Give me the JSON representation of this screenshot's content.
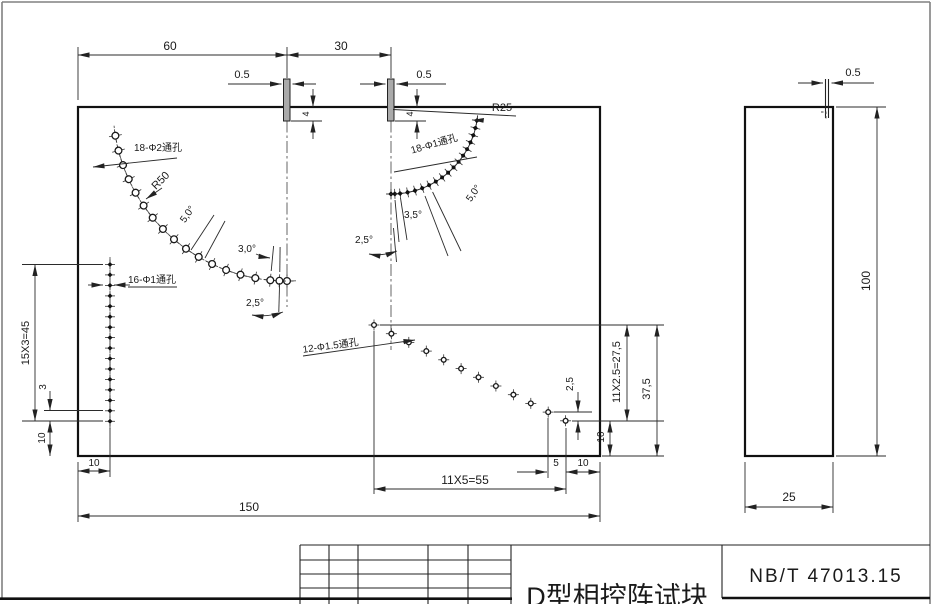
{
  "labels": {
    "dim_width_60": "60",
    "dim_width_30": "30",
    "notch1_width": "0.5",
    "notch2_width": "0.5",
    "side_notch_width": "0.5",
    "notch1_depth": "4",
    "notch2_depth": "4",
    "radius_r50": "R50",
    "radius_r25": "R25",
    "holes_arc_r50": "18-Φ2通孔",
    "holes_arc_r25": "18-Φ1通孔",
    "holes_column": "16-Φ1通孔",
    "holes_diagonal": "12-Φ1.5通孔",
    "angle_left_5": "5,0°",
    "angle_left_3": "3,0°",
    "angle_left_25": "2,5°",
    "angle_right_5": "5,0°",
    "angle_right_35": "3,5°",
    "angle_right_25": "2,5°",
    "dim_column_pitch": "15X3=45",
    "dim_column_gap": "3",
    "dim_column_bottom": "10",
    "dim_column_left": "10",
    "dim_total_width": "150",
    "dim_diag_pitch": "11X5=55",
    "dim_diag_last": "5",
    "dim_diag_right": "10",
    "dim_diag_vgap": "2,5",
    "dim_diag_vpitch": "11X2.5=27,5",
    "dim_first_hole_height": "37,5",
    "dim_last_hole_height": "10",
    "side_height": "100",
    "side_width": "25"
  },
  "title_block": {
    "standard": "NB/T 47013.15",
    "part_name": "D型相控阵试块"
  },
  "hole_patterns": [
    {
      "name": "holes-arc-r50",
      "type": "arc",
      "cx": 287,
      "cy": 107,
      "r": 174,
      "dir": -1,
      "count": 18,
      "offsets": [
        0,
        2.5,
        5.5,
        10.5,
        15.5,
        20.5,
        25.5,
        30.5,
        35.5,
        40.5,
        45.5,
        50.5,
        55.5,
        60.5,
        65.5,
        70.5,
        75.5,
        80.5
      ],
      "style": "circle",
      "hr": 3.4,
      "tick": 6.5
    },
    {
      "name": "holes-arc-r25",
      "type": "arc",
      "cx": 391,
      "cy": 107,
      "r": 87,
      "dir": 1,
      "count": 18,
      "offsets": [
        0,
        2.5,
        6,
        11,
        16,
        21,
        26,
        31,
        36,
        41,
        46,
        51,
        56,
        61,
        66,
        71,
        76,
        81
      ],
      "style": "diamond",
      "hr": 2.7,
      "tick": 5
    },
    {
      "name": "holes-column",
      "type": "line",
      "x0": 110,
      "y0": 264.5,
      "dx": 0,
      "dy": 10.45,
      "count": 16,
      "style": "diamond",
      "hr": 2.5,
      "tick": 5
    },
    {
      "name": "holes-diagonal",
      "type": "line",
      "x0": 374,
      "y0": 325,
      "dx": 17.42,
      "dy": 8.71,
      "count": 12,
      "style": "circle",
      "hr": 2.4,
      "tick": 5.5
    }
  ]
}
